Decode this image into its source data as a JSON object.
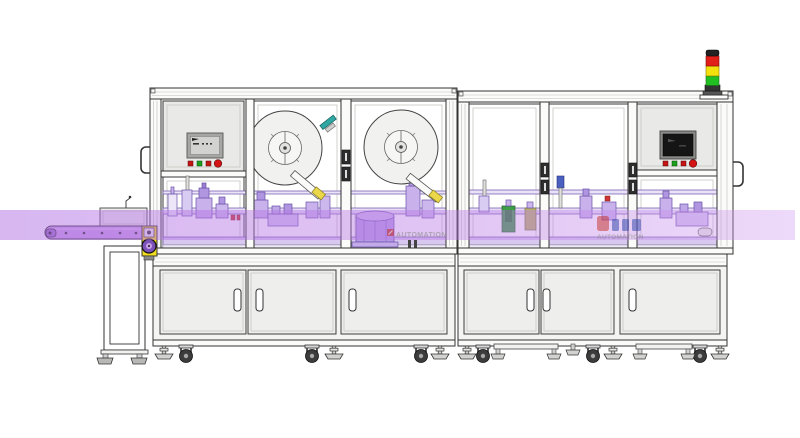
{
  "watermarks": {
    "left": {
      "text": "AUTOMATION"
    },
    "right": {
      "text": "AUTOMATION"
    }
  },
  "signal_tower": {
    "lights": [
      {
        "name": "red",
        "color": "#e2201a"
      },
      {
        "name": "yellow",
        "color": "#f2e10c"
      },
      {
        "name": "green",
        "color": "#22bf22"
      }
    ]
  },
  "hmi_left": {
    "buttons": [
      {
        "name": "red-button",
        "color": "#c41414"
      },
      {
        "name": "green-button",
        "color": "#1ba01b"
      },
      {
        "name": "red-button",
        "color": "#c41414"
      },
      {
        "name": "red-round-button",
        "color": "#d41414"
      }
    ]
  },
  "hmi_right": {
    "buttons": [
      {
        "name": "red-button",
        "color": "#c41414"
      },
      {
        "name": "green-button",
        "color": "#1ba01b"
      },
      {
        "name": "red-button",
        "color": "#c41414"
      },
      {
        "name": "red-round-button",
        "color": "#d41414"
      }
    ]
  },
  "colors": {
    "highlight_band": "#b873e4",
    "conveyor_belt": "#c9a0e8",
    "machinery_purple": "#c7b0ea",
    "drive_housing_yellow": "#f2dc1e",
    "frame_outline": "#333333",
    "cabinet_gray": "#efefed"
  }
}
